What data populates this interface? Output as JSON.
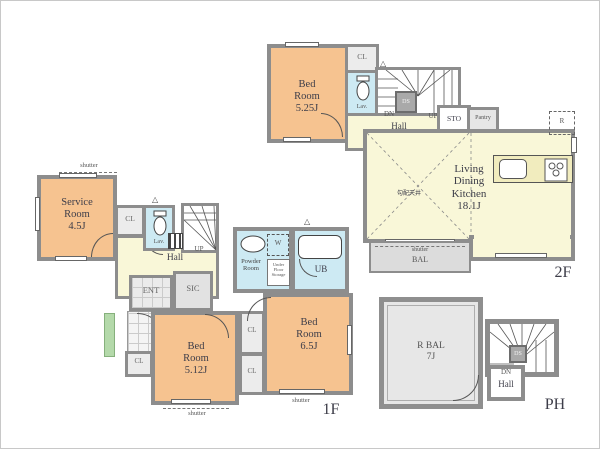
{
  "f2": {
    "floor_label": "2F",
    "bedroom": {
      "l1": "Bed",
      "l2": "Room",
      "l3": "5.25J"
    },
    "cl": "CL",
    "lav": "Lav.",
    "dn": "DN",
    "up": "UP",
    "hall": "Hall",
    "ds": "DS",
    "sto": "STO",
    "pantry": "Pantry",
    "ldk": {
      "l1": "Living",
      "l2": "Dining",
      "l3": "Kitchen",
      "l4": "18.1J"
    },
    "sloped_ceiling": "勾配天井",
    "fridge": "R",
    "shutter": "shutter",
    "bal": "BAL"
  },
  "f1": {
    "floor_label": "1F",
    "shutter": "shutter",
    "service": {
      "l1": "Service",
      "l2": "Room",
      "l3": "4.5J"
    },
    "cl": "CL",
    "lav": "Lav.",
    "up": "UP",
    "hall": "Hall",
    "ent": "ENT",
    "sic": "SIC",
    "bed_a": {
      "l1": "Bed",
      "l2": "Room",
      "l3": "5.12J"
    },
    "bed_b": {
      "l1": "Bed",
      "l2": "Room",
      "l3": "6.5J"
    },
    "powder": {
      "l1": "Powder",
      "l2": "Room"
    },
    "washer": "W",
    "ufs": {
      "l1": "Under",
      "l2": "Floor",
      "l3": "Storage"
    },
    "ub": "UB"
  },
  "ph": {
    "floor_label": "PH",
    "rbal": {
      "l1": "R BAL",
      "l2": "7J"
    },
    "dn": "DN",
    "hall": "Hall",
    "ds": "DS"
  },
  "colors": {
    "room_orange": "#f6c390",
    "hall_yellow": "#f9f7d8",
    "water_blue": "#cdeaf3",
    "wall_gray": "#8d8d8d",
    "closet_gray": "#ececec",
    "balcony_gray": "#dcdcdc",
    "approach_green": "#b4d9aa"
  }
}
